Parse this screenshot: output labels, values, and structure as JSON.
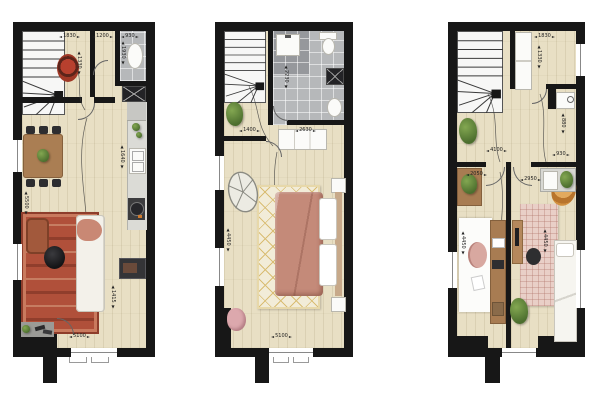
{
  "document": {
    "kind": "architectural-floor-plans",
    "plan_count": 3,
    "background": "#ffffff"
  },
  "palette": {
    "wall": "#171717",
    "wood_floor": "#e8dfc4",
    "bathroom_tile": "#b6b8ba",
    "shower_tile": "#96989c",
    "staircase": "#f7f7f6",
    "oriental_rug": "#b0503a",
    "trellis_rug": "#f2ecd8",
    "trellis_line": "#d9bd74",
    "pink_rug": "#e9cfc7",
    "bed_blanket": "#c48a79",
    "wood_furniture": "#a87c52",
    "plant_green": "#4c6e2e",
    "papasan_orange": "#d29040",
    "dimension_text": "#222222"
  },
  "plans": [
    {
      "id": "plan-1",
      "dimensions": {
        "hall_width": "1830",
        "wc_width": "1200",
        "storage_width": "930",
        "hall_depth": "1330",
        "storage_depth": "1930",
        "living_length": "5500",
        "kitchen_length": "1640",
        "entry_depth": "1415",
        "overall_width": "5100"
      },
      "features": [
        "winder-staircase",
        "hall-rug",
        "toilet",
        "washbasin",
        "appliance",
        "kitchen-counter",
        "kitchen-sink",
        "cooktop",
        "dining-table",
        "dining-chairs",
        "houseplant",
        "armchair",
        "coffee-table",
        "sofa",
        "oriental-rug",
        "tv-cabinet",
        "doormat",
        "shoes",
        "front-door",
        "windows",
        "entry-path"
      ]
    },
    {
      "id": "plan-2",
      "dimensions": {
        "landing_width": "1400",
        "bathroom_width": "2630",
        "bathroom_depth": "2230",
        "bedroom_length": "4450",
        "overall_width": "5100"
      },
      "features": [
        "winder-staircase",
        "shower",
        "washbasin",
        "toilet",
        "washing-machine",
        "vanity-sink",
        "houseplant",
        "dresser",
        "rattan-chair",
        "trellis-rug",
        "double-bed",
        "nightstands",
        "pouf",
        "windows",
        "entry-path"
      ]
    },
    {
      "id": "plan-3",
      "dimensions": {
        "closet_width": "1830",
        "closet_depth": "1330",
        "landing_width": "4100",
        "niche_width": "930",
        "niche_depth": "880",
        "room_left_width": "2050",
        "room_right_width": "2950",
        "room_left_length": "4450",
        "room_right_length": "4450"
      },
      "features": [
        "winder-staircase",
        "wardrobe",
        "boiler",
        "houseplant",
        "planter-bench",
        "kitchenette-counter",
        "desk",
        "desk-chair",
        "white-rug",
        "office-desk",
        "office-chair",
        "pink-rug",
        "single-bed",
        "papasan-chair",
        "windows",
        "entry-path"
      ]
    }
  ]
}
